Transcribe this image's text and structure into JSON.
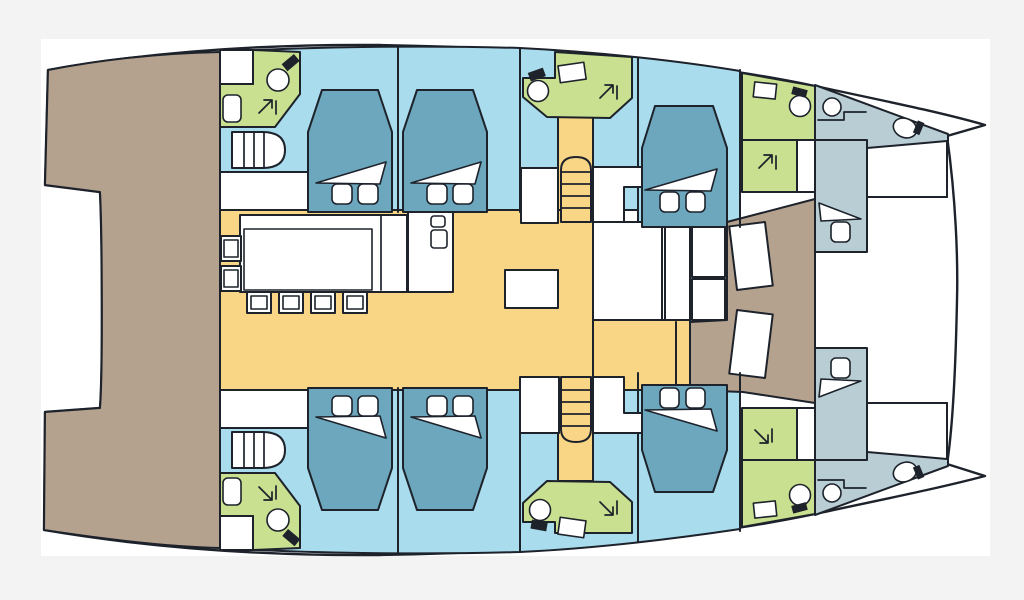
{
  "meta": {
    "title": "Catamaran interior deck plan (top view)",
    "kind": "boat-floor-plan",
    "orientation": {
      "bow": "right",
      "stern": "left"
    },
    "text_visible_on_screen": []
  },
  "palette": {
    "bg": "#f3f3f3",
    "canvas": "#ffffff",
    "outline": "#1d222b",
    "deck_tan": "#b4a28f",
    "cabin_blue": "#a9dced",
    "floor_yellow": "#f9d686",
    "bath_green": "#c8e08f",
    "bow_gray": "#b8ced4",
    "bed_blue": "#6ca7bd",
    "fixture_dark": "#14181f"
  },
  "areas": [
    {
      "id": "aft-deck",
      "label": "aft deck / cockpit",
      "color_key": "deck_tan"
    },
    {
      "id": "forward-deck",
      "label": "forward deck between hulls",
      "color_key": "deck_tan"
    },
    {
      "id": "salon-galley",
      "label": "salon, galley and dinette floor",
      "color_key": "floor_yellow"
    },
    {
      "id": "companionway-forward",
      "label": "forward companionway with steps",
      "color_key": "floor_yellow"
    },
    {
      "id": "companionway-aft",
      "label": "aft companionway with steps",
      "color_key": "floor_yellow"
    },
    {
      "id": "port-aft-cabin",
      "label": "port aft double cabin",
      "color_key": "cabin_blue"
    },
    {
      "id": "port-mid-cabin",
      "label": "port mid double cabin",
      "color_key": "cabin_blue"
    },
    {
      "id": "starboard-aft-cabin",
      "label": "starboard aft double cabin",
      "color_key": "cabin_blue"
    },
    {
      "id": "starboard-mid-cabin",
      "label": "starboard mid double cabin",
      "color_key": "cabin_blue"
    },
    {
      "id": "port-forward-cabin",
      "label": "port forward double cabin",
      "color_key": "cabin_blue"
    },
    {
      "id": "starboard-forward-cabin",
      "label": "starboard forward double cabin",
      "color_key": "cabin_blue"
    },
    {
      "id": "port-aft-head",
      "label": "port aft bathroom with shower",
      "color_key": "bath_green"
    },
    {
      "id": "starboard-aft-head",
      "label": "starboard aft bathroom with shower",
      "color_key": "bath_green"
    },
    {
      "id": "port-mid-head",
      "label": "port mid bathroom",
      "color_key": "bath_green"
    },
    {
      "id": "starboard-mid-head",
      "label": "starboard mid bathroom",
      "color_key": "bath_green"
    },
    {
      "id": "port-forward-head",
      "label": "port forward bathroom and shower",
      "color_key": "bath_green"
    },
    {
      "id": "starboard-forward-head",
      "label": "starboard forward bathroom and shower",
      "color_key": "bath_green"
    },
    {
      "id": "port-bow-crew-cabin",
      "label": "port bow crew cabin with toilet",
      "color_key": "bow_gray"
    },
    {
      "id": "starboard-bow-crew-cabin",
      "label": "starboard bow crew cabin with toilet",
      "color_key": "bow_gray"
    }
  ],
  "furniture": {
    "double_berths": 6,
    "single_crew_berths": 2,
    "pillows_per_double_berth": 2,
    "staircases": 4,
    "dinette_chairs": 6,
    "galley_island": 1,
    "salon_side_table": 1,
    "deck_hatches": 2,
    "toilets": 6,
    "sinks": 6,
    "shower_symbols": 6
  },
  "icons": [
    {
      "name": "toilet-icon",
      "glyph": "circle bowl with dark cistern"
    },
    {
      "name": "sink-icon",
      "glyph": "small rounded rectangle"
    },
    {
      "name": "shower-arrow-icon",
      "glyph": "diagonal arrow with tick"
    },
    {
      "name": "stairs-icon",
      "glyph": "rounded ladder treads"
    },
    {
      "name": "bed-icon",
      "glyph": "tapered mattress, two pillows, folded sheet"
    }
  ]
}
